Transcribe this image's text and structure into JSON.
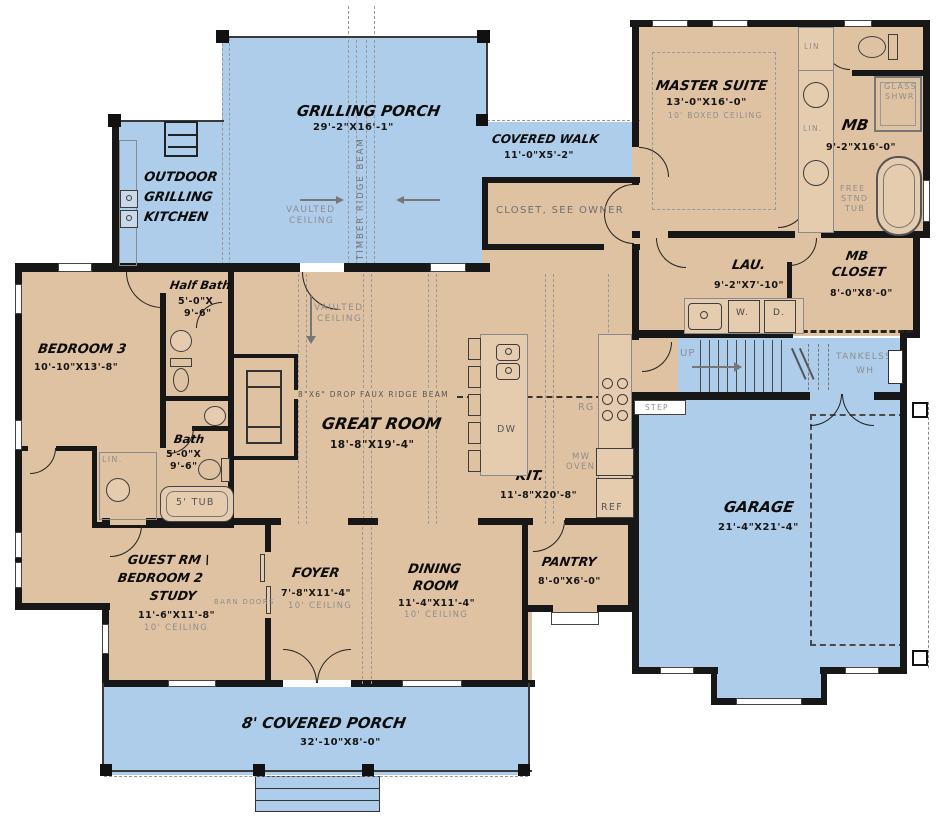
{
  "colors": {
    "outdoor": "#adcdea",
    "interior": "#dfc2a2",
    "wall": "#171717",
    "note_gray": "#8e8e8e"
  },
  "rooms": {
    "grilling_porch": {
      "name": "GRILLING PORCH",
      "dims": "29'-2\"X16'-1\"",
      "ceiling_l1": "VAULTED",
      "ceiling_l2": "CEILING",
      "beam": "TIMBER RIDGE BEAM"
    },
    "outdoor_kitchen": {
      "l1": "OUTDOOR",
      "l2": "GRILLING",
      "l3": "KITCHEN"
    },
    "covered_walk": {
      "name": "COVERED WALK",
      "dims": "11'-0\"X5'-2\""
    },
    "owner_closet": {
      "name": "CLOSET, SEE OWNER"
    },
    "master_suite": {
      "name": "MASTER SUITE",
      "dims": "13'-0\"X16'-0\"",
      "note": "10' BOXED CEILING"
    },
    "master_bath": {
      "name": "MB",
      "dims": "9'-2\"X16'-0\"",
      "glass_l1": "GLASS",
      "glass_l2": "SHWR",
      "tub_l1": "FREE",
      "tub_l2": "STND",
      "tub_l3": "TUB",
      "lin": "LIN",
      "lin2": "LIN."
    },
    "mb_closet": {
      "l1": "MB",
      "l2": "CLOSET",
      "dims": "8'-0\"X8'-0\""
    },
    "laundry": {
      "name": "LAU.",
      "dims": "9'-2\"X7'-10\"",
      "washer": "W.",
      "dryer": "D."
    },
    "half_bath": {
      "name": "Half Bath",
      "dims_l1": "5'-0\"X",
      "dims_l2": "9'-6\""
    },
    "bedroom3": {
      "name": "BEDROOM 3",
      "dims": "10'-10\"X13'-8\""
    },
    "bath": {
      "name": "Bath",
      "dims_l1": "5'-0\"X",
      "dims_l2": "9'-6\"",
      "tub": "5' TUB",
      "lin": "LIN."
    },
    "great_room": {
      "name": "GREAT ROOM",
      "dims": "18'-8\"X19'-4\"",
      "ceiling_l1": "VAULTED",
      "ceiling_l2": "CEILING",
      "beam": "8\"X6\" DROP FAUX RIDGE BEAM"
    },
    "kitchen": {
      "name": "KIT.",
      "dims": "11'-8\"X20'-8\"",
      "range": "RG",
      "micro_l1": "MW",
      "micro_l2": "OVEN",
      "fridge": "REF",
      "dishwasher": "DW"
    },
    "pantry": {
      "name": "PANTRY",
      "dims": "8'-0\"X6'-0\""
    },
    "dining": {
      "l1": "DINING",
      "l2": "ROOM",
      "dims": "11'-4\"X11'-4\"",
      "note": "10' CEILING"
    },
    "foyer": {
      "name": "FOYER",
      "dims": "7'-8\"X11'-4\"",
      "note": "10' CEILING"
    },
    "guest": {
      "l1": "GUEST RM \\",
      "l2": "BEDROOM 2",
      "l3": "STUDY",
      "dims": "11'-6\"X11'-8\"",
      "note": "10' CEILING",
      "barn_doors": "BARN DOORS"
    },
    "garage": {
      "name": "GARAGE",
      "dims": "21'-4\"X21'-4\""
    },
    "covered_porch": {
      "name": "8' COVERED PORCH",
      "dims": "32'-10\"X8'-0\""
    },
    "stairs": {
      "up": "UP",
      "step": "STEP",
      "wh_l1": "TANKELSS",
      "wh_l2": "WH"
    }
  }
}
